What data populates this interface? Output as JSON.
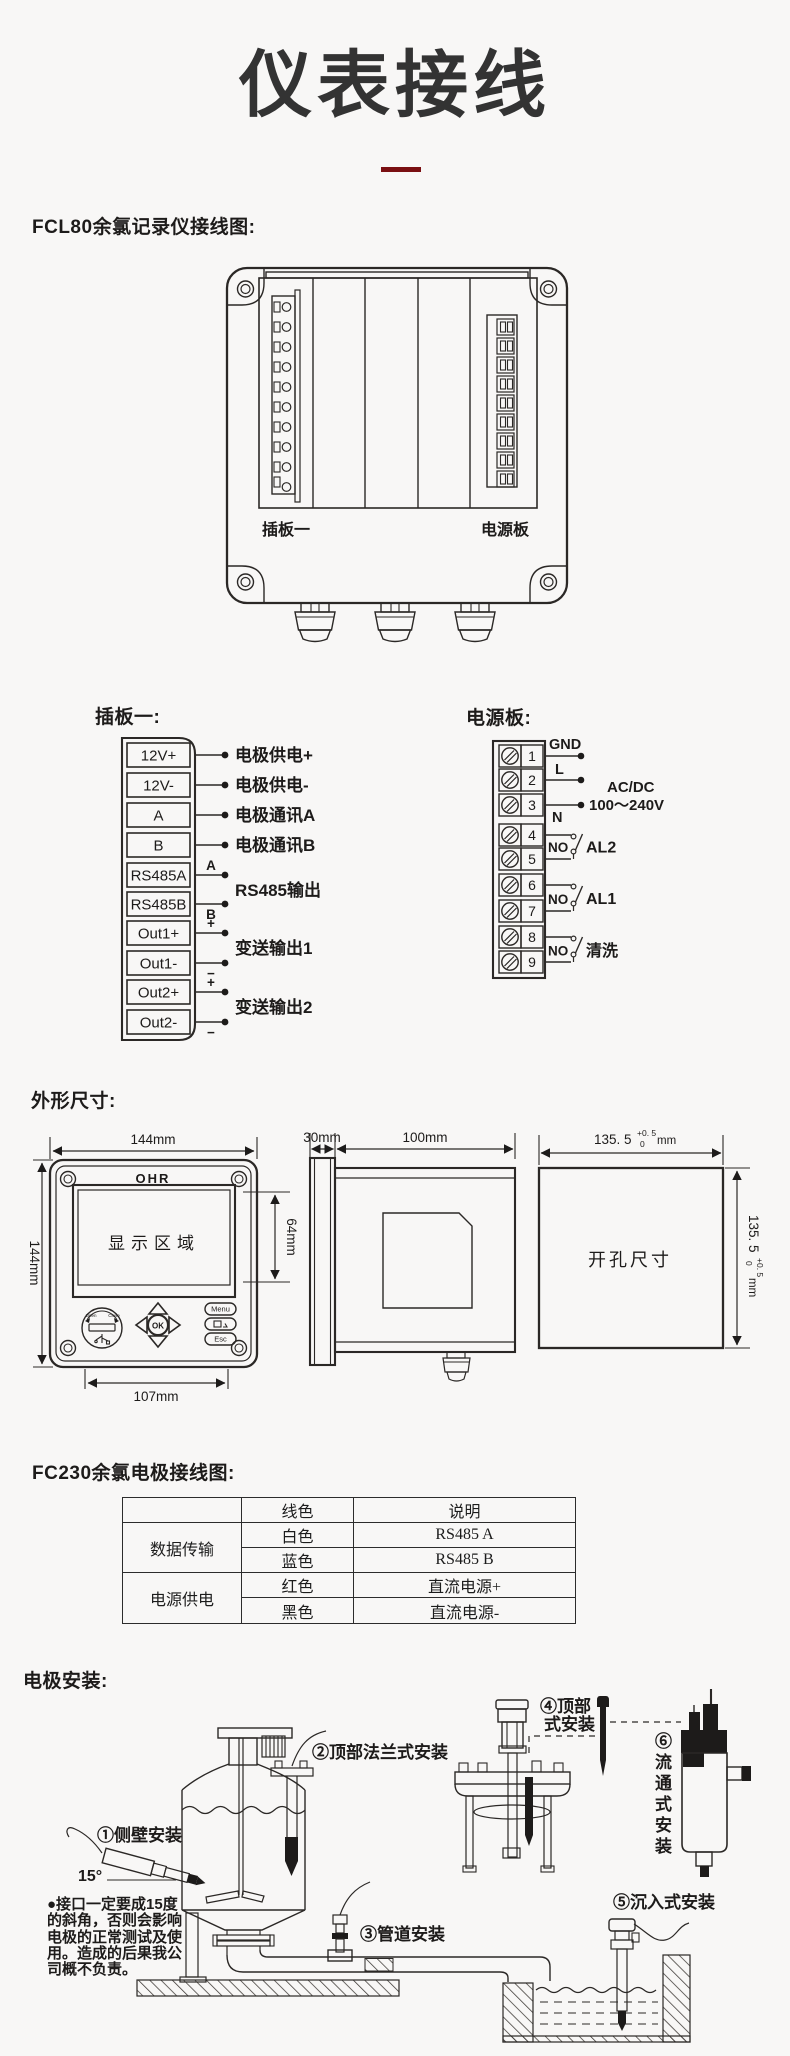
{
  "page": {
    "title": "仪表接线"
  },
  "fcl80": {
    "heading": "FCL80余氯记录仪接线图:",
    "slot1_label": "插板一",
    "power_label": "电源板"
  },
  "plugboard": {
    "heading": "插板一:",
    "terminals": [
      "12V+",
      "12V-",
      "A",
      "B",
      "RS485A",
      "RS485B",
      "Out1+",
      "Out1-",
      "Out2+",
      "Out2-"
    ],
    "tag_a": "A",
    "tag_b": "B",
    "tag_plus1": "+",
    "tag_minus1": "−",
    "tag_plus2": "+",
    "tag_minus2": "−",
    "labels": [
      "电极供电+",
      "电极供电-",
      "电极通讯A",
      "电极通讯B",
      "RS485输出",
      "变送输出1",
      "变送输出2"
    ]
  },
  "powerboard": {
    "heading": "电源板:",
    "numbers": [
      "1",
      "2",
      "3",
      "4",
      "5",
      "6",
      "7",
      "8",
      "9"
    ],
    "gnd": "GND",
    "live": "L",
    "neutral": "N",
    "supply1": "AC/DC",
    "supply2": "100～240V",
    "no1": "NO",
    "no2": "NO",
    "no3": "NO",
    "relay1": "AL2",
    "relay2": "AL1",
    "relay3": "清洗"
  },
  "dims": {
    "heading": "外形尺寸:",
    "width": "144mm",
    "height": "144mm",
    "bottom": "107mm",
    "display_h": "64mm",
    "logo": "OHR",
    "display": "显示区域",
    "ok": "OK",
    "menu": "Menu",
    "esc": "Esc",
    "usb_open": "Open",
    "usb_close": "Close",
    "side_panel": "30mm",
    "side_depth": "100mm",
    "cutout": "开孔尺寸",
    "cut_w": "135. 5",
    "cut_tol_up": "+0. 5",
    "cut_tol_dn": "0",
    "cut_unit": "mm"
  },
  "fc230": {
    "heading": "FC230余氯电极接线图:",
    "col_color": "线色",
    "col_desc": "说明",
    "g1": "数据传输",
    "g1r1c": "白色",
    "g1r1d": "RS485 A",
    "g1r2c": "蓝色",
    "g1r2d": "RS485 B",
    "g2": "电源供电",
    "g2r1c": "红色",
    "g2r1d": "直流电源+",
    "g2r2c": "黑色",
    "g2r2d": "直流电源-"
  },
  "install": {
    "heading": "电极安装:",
    "lbl1": "①侧壁安装",
    "angle": "15°",
    "lbl2": "②顶部法兰式安装",
    "lbl3": "③管道安装",
    "lbl4a": "④顶部",
    "lbl4b": "式安装",
    "lbl5": "⑤沉入式安装",
    "lbl6": "⑥流通式安装",
    "note1": "●接口一定要成15度",
    "note2": "的斜角，否则会影响",
    "note3": "电极的正常测试及使",
    "note4": "用。造成的后果我公",
    "note5": "司概不负责。"
  }
}
